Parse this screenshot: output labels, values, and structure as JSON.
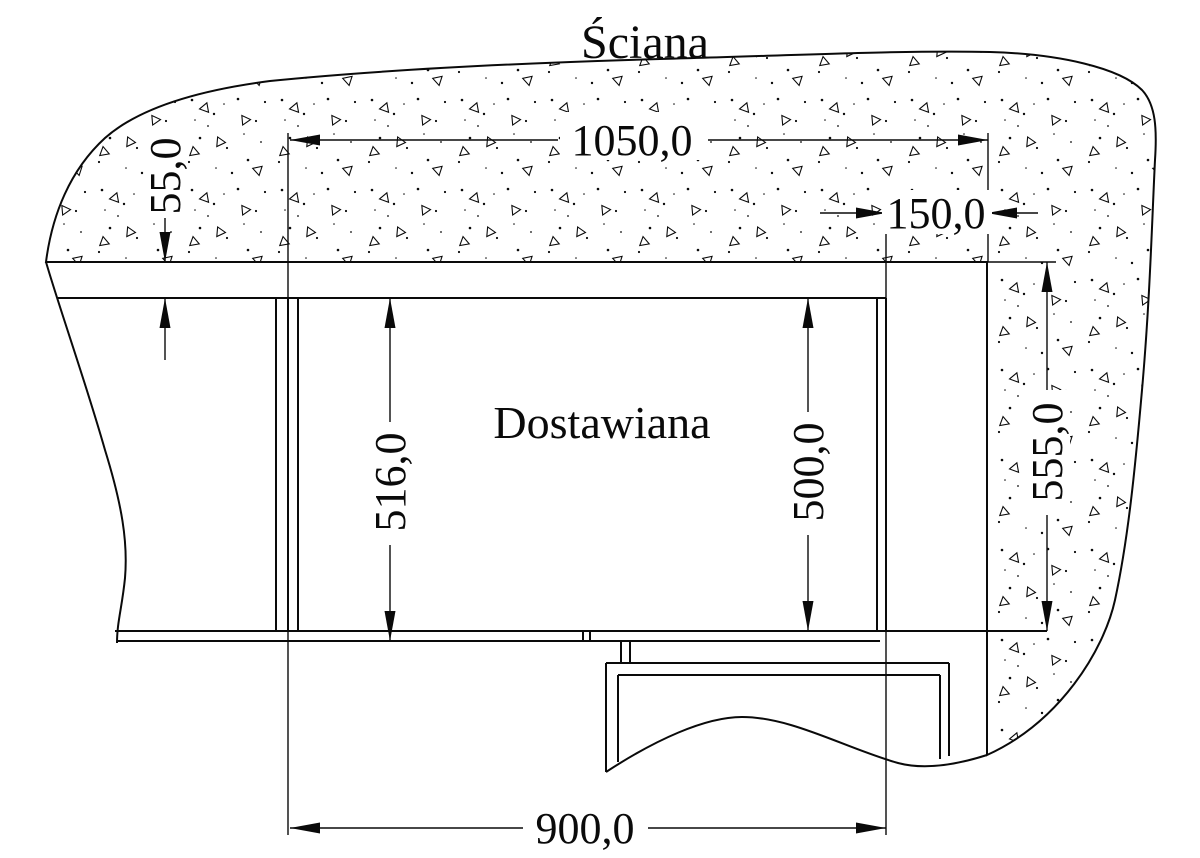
{
  "title": "Ściana",
  "drawing": {
    "cabinet_label": "Dostawiana",
    "dimensions": {
      "top_width": "1050,0",
      "wall_offset": "55,0",
      "right_gap": "150,0",
      "left_height": "516,0",
      "inner_height": "500,0",
      "right_height": "555,0",
      "bottom_width": "900,0"
    }
  },
  "colors": {
    "line": "#0a0a0a",
    "background": "#ffffff"
  }
}
